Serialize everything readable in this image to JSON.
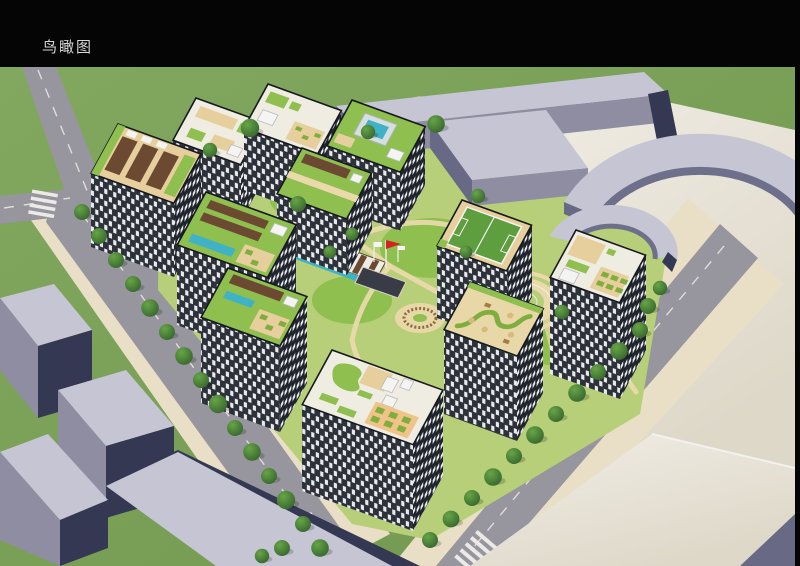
{
  "title": {
    "text": "鸟瞰图"
  },
  "palette": {
    "background": "#050505",
    "title_color": "#d8d8d8",
    "grass": "#82a860",
    "grass_deep": "#72984e",
    "road": "#97959d",
    "road_line": "#eceae6",
    "sidewalk": "#e8dfc6",
    "courtyard": "#b7cf78",
    "lawn": "#8fbf4f",
    "path_tan": "#e9d9ab",
    "facade_dark": "#2d313a",
    "facade_darker": "#20242c",
    "facade_window": "#e9eaec",
    "parapet": "#15181e",
    "roof_white": "#efece2",
    "roof_tan": "#e6cf9c",
    "roof_sand": "#e8d8a8",
    "pergola": "#6b4a31",
    "pool": "#3fb3c5",
    "field": "#5f9e3e",
    "terrace": "#f0c488",
    "planter": "#7fae3f",
    "tree_core": "#67a546",
    "tree_edge": "#2f5c2b",
    "context_top": "#c6c5d3",
    "context_front": "#8e8da2",
    "context_side": "#686a85",
    "context_dark": "#343852",
    "plaza": "#f2eee6",
    "plaza_shade": "#ded8c9",
    "flag_red": "#d2231f",
    "white": "#f4f4f2"
  }
}
